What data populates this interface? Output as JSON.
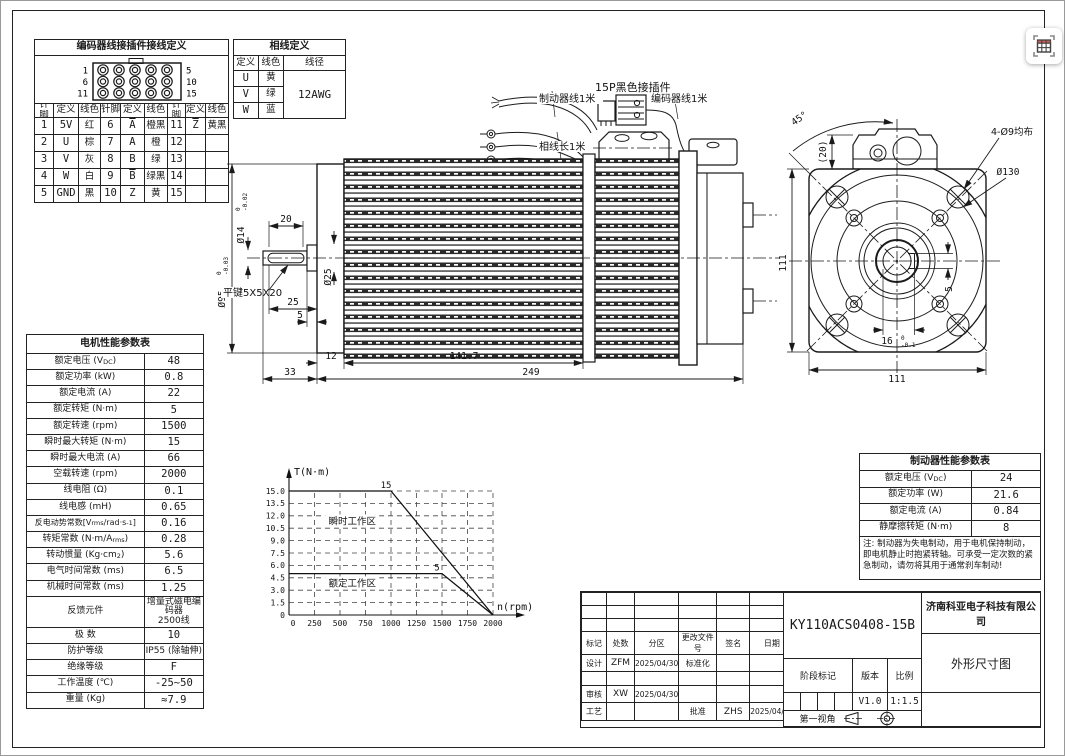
{
  "encoder_table": {
    "title": "编码器线接插件接线定义",
    "connector": {
      "left_labels": [
        "1",
        "6",
        "11"
      ],
      "right_labels": [
        "5",
        "10",
        "15"
      ]
    },
    "headers": [
      "针脚",
      "定义",
      "线色",
      "针脚",
      "定义",
      "线色",
      "针脚",
      "定义",
      "线色"
    ],
    "rows": [
      [
        "1",
        "5V",
        "红",
        "6",
        "<span class=\"ov\">A</span>",
        "橙黑",
        "11",
        "<span class=\"ov\">Z</span>",
        "黄黑"
      ],
      [
        "2",
        "U",
        "棕",
        "7",
        "A",
        "橙",
        "12",
        "",
        ""
      ],
      [
        "3",
        "V",
        "灰",
        "8",
        "B",
        "绿",
        "13",
        "",
        ""
      ],
      [
        "4",
        "W",
        "白",
        "9",
        "<span class=\"ov\">B</span>",
        "绿黑",
        "14",
        "",
        ""
      ],
      [
        "5",
        "GND",
        "黑",
        "10",
        "Z",
        "黄",
        "15",
        "",
        ""
      ]
    ]
  },
  "phase_table": {
    "title": "相线定义",
    "headers": [
      "定义",
      "线色",
      "线径"
    ],
    "rows": [
      [
        "U",
        "黄"
      ],
      [
        "V",
        "绿"
      ],
      [
        "W",
        "蓝"
      ]
    ],
    "gauge": "12AWG"
  },
  "motor_table": {
    "title": "电机性能参数表",
    "rows": [
      {
        "label": "额定电压 (V<sub>DC</sub>)",
        "value": "48"
      },
      {
        "label": "额定功率 (kW)",
        "value": "0.8"
      },
      {
        "label": "额定电流 (A)",
        "value": "22"
      },
      {
        "label": "额定转矩 (N·m)",
        "value": "5"
      },
      {
        "label": "额定转速 (rpm)",
        "value": "1500"
      },
      {
        "label": "瞬时最大转矩 (N·m)",
        "value": "15"
      },
      {
        "label": "瞬时最大电流 (A)",
        "value": "66"
      },
      {
        "label": "空载转速 (rpm)",
        "value": "2000"
      },
      {
        "label": "线电阻 (Ω)",
        "value": "0.1"
      },
      {
        "label": "线电感 (mH)",
        "value": "0.65"
      },
      {
        "label": "反电动势常数[V<sub>rms</sub>/rad·s<sup>-1</sup>]",
        "value": "0.16"
      },
      {
        "label": "转矩常数 (N·m/A<sub>rms</sub>)",
        "value": "0.28"
      },
      {
        "label": "转动惯量 (Kg·cm<sup>2</sup>)",
        "value": "5.6"
      },
      {
        "label": "电气时间常数 (ms)",
        "value": "6.5"
      },
      {
        "label": "机械时间常数 (ms)",
        "value": "1.25"
      },
      {
        "label": "反馈元件",
        "value": "增量式磁电编码器<br>2500线"
      },
      {
        "label": "极 数",
        "value": "10"
      },
      {
        "label": "防护等级",
        "value": "IP55 (除轴伸)"
      },
      {
        "label": "绝缘等级",
        "value": "F"
      },
      {
        "label": "工作温度 (℃)",
        "value": "-25~50"
      },
      {
        "label": "重量 (Kg)",
        "value": "≈7.9"
      }
    ]
  },
  "brake_table": {
    "title": "制动器性能参数表",
    "rows": [
      {
        "label": "额定电压 (V<sub>DC</sub>)",
        "value": "24"
      },
      {
        "label": "额定功率 (W)",
        "value": "21.6"
      },
      {
        "label": "额定电流 (A)",
        "value": "0.84"
      },
      {
        "label": "静摩擦转矩 (N·m)",
        "value": "8"
      }
    ],
    "note": "注: 制动器为失电制动，用于电机保持制动，即电机静止时抱紧转轴。可承受一定次数的紧急制动，请勿将其用于通常刹车制动!"
  },
  "chart_data": {
    "type": "line",
    "title": "",
    "xlabel": "n(rpm)",
    "ylabel": "T(N·m)",
    "xlim": [
      0,
      2000
    ],
    "ylim": [
      0,
      15
    ],
    "x_ticks": [
      0,
      250,
      500,
      750,
      1000,
      1250,
      1500,
      1750,
      2000
    ],
    "y_ticks": [
      "0",
      "1.5",
      "3.0",
      "4.5",
      "6.0",
      "7.5",
      "9.0",
      "10.5",
      "12.0",
      "13.5",
      "15.0"
    ],
    "grid": "dashed",
    "legend": "none",
    "series": [
      {
        "name": "瞬时最大转矩曲线",
        "points": [
          [
            0,
            15
          ],
          [
            1000,
            15
          ],
          [
            2000,
            0
          ]
        ],
        "point_label": "15",
        "label_at": [
          1000,
          15
        ]
      },
      {
        "name": "额定转矩曲线",
        "points": [
          [
            0,
            5
          ],
          [
            1500,
            5
          ],
          [
            2000,
            0
          ]
        ],
        "point_label": "5",
        "label_at": [
          1500,
          5
        ]
      }
    ],
    "annotations": [
      {
        "text": "瞬时工作区",
        "x": 620,
        "y": 11.2
      },
      {
        "text": "额定工作区",
        "x": 620,
        "y": 3.7
      }
    ]
  },
  "side_view": {
    "labels": {
      "brake_wire": "制动器线1米",
      "connector": "15P黑色接插件",
      "encoder_wire": "编码器线1米",
      "phase_wire": "相线长1米",
      "key_spec": "平键5X5X20"
    },
    "dims": {
      "flange_dia": "Ø95",
      "flange_tol_hi": "0",
      "flange_tol_lo": "-0.03",
      "shaft_dia": "Ø14",
      "shaft_tol_hi": "0",
      "shaft_tol_lo": "-0.02",
      "step_dia": "Ø25",
      "key_len": "20",
      "len_25": "25",
      "len_5": "5",
      "len_12": "12",
      "len_141_7": "141.7",
      "len_33": "33",
      "len_249": "249"
    }
  },
  "front_view": {
    "dims": {
      "angle": "45°",
      "conn_h": "(20)",
      "holes": "4-Ø9均布",
      "outer_dia": "Ø130",
      "height_111": "111",
      "width_111": "111",
      "key_w": "5",
      "key_d": "16",
      "key_tol_hi": "0",
      "key_tol_lo": "-0.1"
    }
  },
  "title_block": {
    "model": "KY110ACS0408-15B",
    "company": "济南科亚电子科技有限公司",
    "drawing_title": "外形尺寸图",
    "columns": [
      "标记",
      "处数",
      "分区",
      "更改文件号",
      "签名",
      "日期"
    ],
    "design_label": "设计",
    "design_sign": "ZFM",
    "design_date": "2025/04/30",
    "standard_label": "标准化",
    "audit_label": "审核",
    "audit_sign": "XW",
    "audit_date": "2025/04/30",
    "process_label": "工艺",
    "approve_label": "批准",
    "approve_sign": "ZHS",
    "approve_date": "2025/04/30",
    "stage_label": "阶段标记",
    "version_label": "版本",
    "scale_label": "比例",
    "version": "V1.0",
    "scale": "1:1.5",
    "projection_label": "第一视角"
  }
}
